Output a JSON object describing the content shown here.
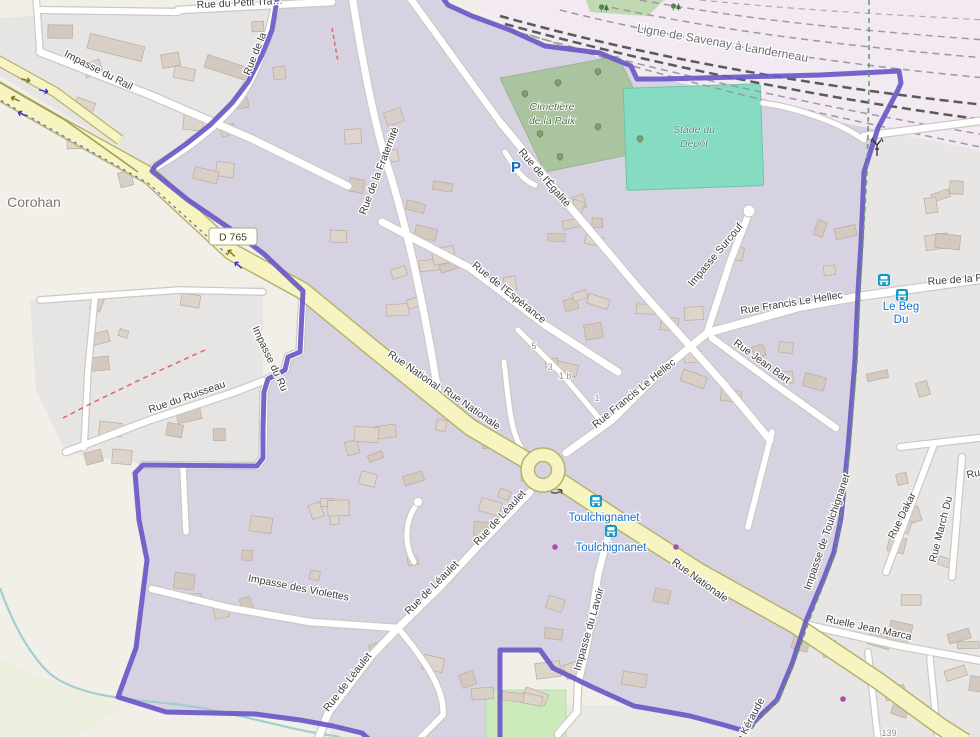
{
  "place_labels": {
    "locality": "Corohan"
  },
  "road_ref_badge": "D 765",
  "railway_label": "Ligne de Savenay à Landerneau",
  "area_labels": {
    "cemetery_line1": "Cimetière",
    "cemetery_line2": "de la Paix",
    "stadium_line1": "Stade du",
    "stadium_line2": "Dépôt"
  },
  "streets": [
    {
      "text": "Impasse du Rail"
    },
    {
      "text": "Rue du Petit Tra…"
    },
    {
      "text": "Rue de la"
    },
    {
      "text": "Rue de la Fraternité"
    },
    {
      "text": "Rue de l'Égalité"
    },
    {
      "text": "Rue de l'Espérance"
    },
    {
      "text": "Impasse Surcouf"
    },
    {
      "text": "Rue Francis Le Hellec"
    },
    {
      "text": "Rue Jean Bart"
    },
    {
      "text": "Rue Francis Le Hellec"
    },
    {
      "text": "Rue National"
    },
    {
      "text": "Rue Nationale"
    },
    {
      "text": "Rue Nationale"
    },
    {
      "text": "Impasse du Ru"
    },
    {
      "text": "Rue du Ruisseau"
    },
    {
      "text": "Impasse des Violettes"
    },
    {
      "text": "Rue de Léaulet"
    },
    {
      "text": "Rue de Léaulet"
    },
    {
      "text": "Rue de Léaulet"
    },
    {
      "text": "Impasse du Lavoir"
    },
    {
      "text": "Impasse de Toulchignanet"
    },
    {
      "text": "Rue Dakar"
    },
    {
      "text": "Rue March Du"
    },
    {
      "text": "Ruelle Jean Marca"
    },
    {
      "text": "Rue de la F"
    },
    {
      "text": "du Kéraude"
    },
    {
      "text": "Ru"
    }
  ],
  "transit_stops": {
    "stop_a": "Toulchignanet",
    "stop_b": "Toulchignanet",
    "stop_c_line1": "Le Beg",
    "stop_c_line2": "Du"
  },
  "house_numbers": {
    "n5": "5",
    "n3": "3",
    "n1b": "1 b",
    "n1": "1",
    "n139": "139"
  },
  "parking_label": "P",
  "icons": {
    "bus": "bus-icon",
    "parking": "parking-icon",
    "antenna": "antenna-mast-icon",
    "tree": "tree-icon",
    "oneway": "oneway-arrow-icon",
    "roundabout_arrow": "roundabout-arrow-icon"
  },
  "colors": {
    "boundary": "#6a58c6",
    "boundary_fill": "#d7d2e1",
    "major_road": "#f7f4c1",
    "residential": "#e7e5e3",
    "land": "#f2efe8",
    "cemetery": "#abc4a0",
    "stadium": "#86dcc3",
    "pitch": "#cdeabd",
    "railway_area": "#f2e9f2",
    "water": "#9fd0cf",
    "transit_text": "#1471cf",
    "bus_icon": "#0d98c9",
    "path_green": "#5fa05f",
    "path_red": "#e06666",
    "street_text": "#3c3c3c"
  }
}
